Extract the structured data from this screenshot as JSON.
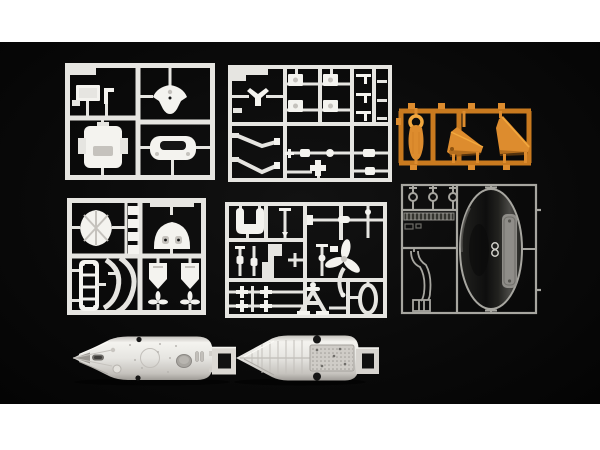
{
  "scene": {
    "type": "product-photo",
    "subject": "plastic scale-model kit sprues (part runners) and two hull halves laid out on a black surface",
    "letterbox_color": "#ffffff",
    "background_color": "#0a0a0a"
  },
  "colors": {
    "letterbox": "#ffffff",
    "white_plastic": "#e6e5e1",
    "white_plastic_bright": "#f4f3ef",
    "white_plastic_shade": "#c5c2bd",
    "white_plastic_dark": "#9e9b96",
    "orange_plastic": "#dd8c2e",
    "orange_plastic_rail": "#c97a1f",
    "orange_plastic_bright": "#f2a83e",
    "orange_plastic_dark": "#8f5410",
    "clear_outline": "#a7a6a0",
    "clear_dim": "#6e6d68",
    "canopy_fill_dark": "#0e0e0e",
    "canopy_mid": "#22221f",
    "canopy_fill_light": "#4a4946",
    "canopy_panel": "#96948f",
    "hole_dark": "#151515"
  },
  "objects": [
    {
      "id": "sprue-a",
      "material": "white plastic",
      "contents": "rectangular plate, large deck part, V-shaped bracket, curved yoke handle"
    },
    {
      "id": "sprue-b",
      "material": "white plastic",
      "contents": "dense grid of small fittings: boxed winches, brackets, rods and angled arms"
    },
    {
      "id": "sprue-c",
      "material": "white plastic",
      "contents": "ribbed pod, dome with two windows, ladder, curved frames, two shield fins with tiny propellers, four square tabs"
    },
    {
      "id": "sprue-d",
      "material": "white plastic",
      "contents": "saddle bracket, shafts and rods, three-blade propeller with curved shaft, cross fittings, stand, oval ring"
    },
    {
      "id": "sprue-orange",
      "material": "orange plastic",
      "contents": "paddle piece with ring eye, two trapezoid dive-plane fins"
    },
    {
      "id": "sprue-clear",
      "material": "clear plastic",
      "contents": "three round lenses, ribbed strip, S-shaped duct, large oval canopy dome"
    },
    {
      "id": "hull-half-exterior",
      "material": "white plastic",
      "contents": "hull half seen from outside: bow cone, scribed circle, dark slot, oval hatch, stern bracket"
    },
    {
      "id": "hull-half-interior",
      "material": "white plastic",
      "contents": "hull half seen from inside: ribs, stippled floor plate, two locating holes, stern bracket"
    }
  ]
}
